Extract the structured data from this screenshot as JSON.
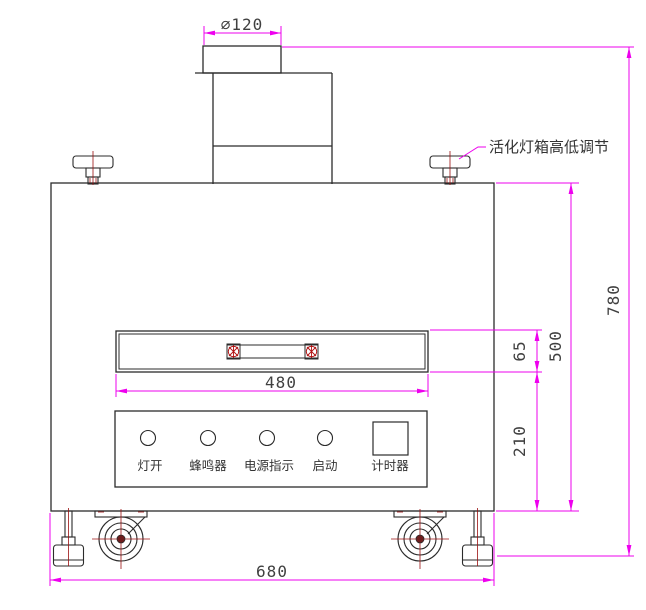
{
  "diagram": {
    "callout": "活化灯箱高低调节",
    "dims": {
      "top_pipe_diameter": "∅120",
      "slot_width": "480",
      "slot_height": "65",
      "cabinet_height": "500",
      "lower_section_height": "210",
      "overall_height": "780",
      "overall_width": "680"
    },
    "panel": {
      "controls": [
        {
          "label": "灯开",
          "shape": "circle"
        },
        {
          "label": "蜂鸣器",
          "shape": "circle"
        },
        {
          "label": "电源指示",
          "shape": "circle"
        },
        {
          "label": "启动",
          "shape": "circle"
        },
        {
          "label": "计时器",
          "shape": "square"
        }
      ]
    },
    "colors": {
      "outline": "#2b2b2b",
      "dimension": "#ee00ee",
      "centerline": "#9b1010",
      "text": "#404040"
    }
  }
}
